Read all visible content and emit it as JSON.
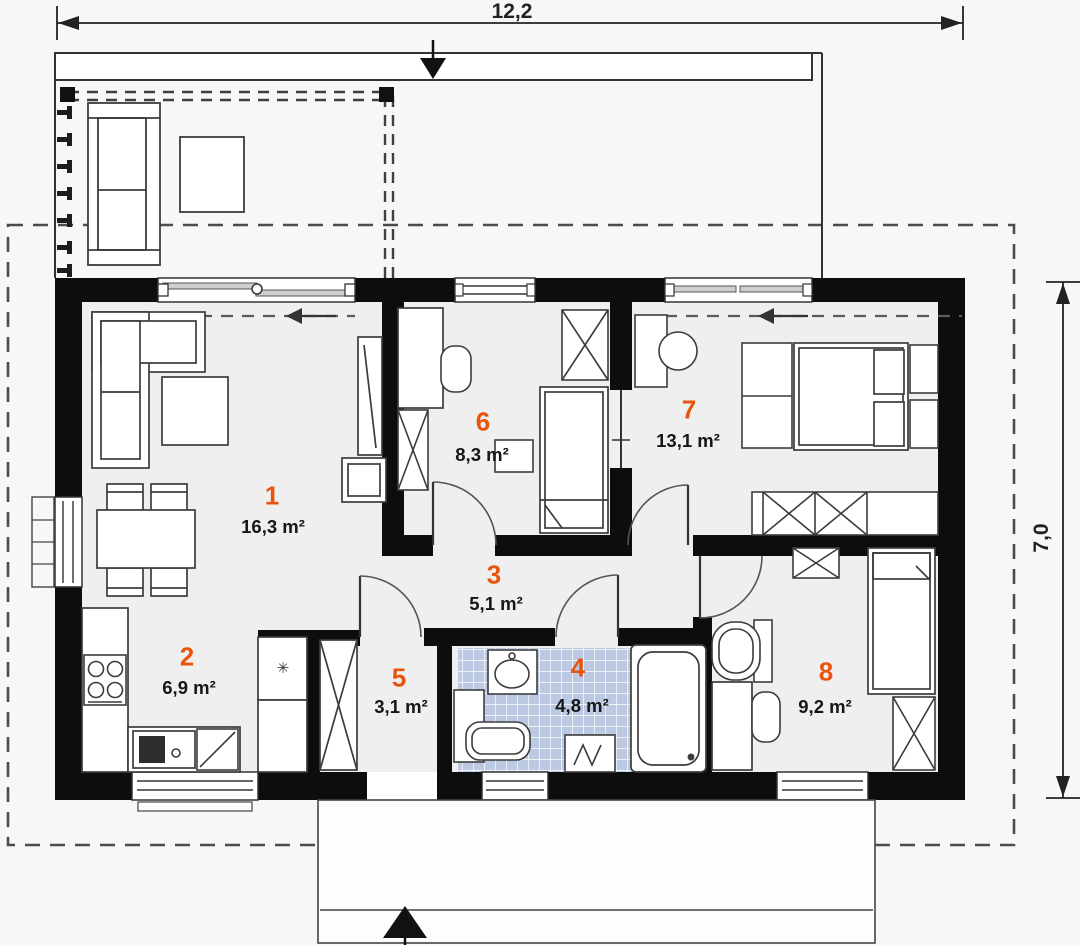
{
  "plan_title": "house-floor-plan",
  "dimensions": {
    "width_label": "12,2",
    "height_label": "7,0"
  },
  "rooms": [
    {
      "number": "1",
      "area": "16,3 m²",
      "name": "living-room"
    },
    {
      "number": "2",
      "area": "6,9 m²",
      "name": "kitchen"
    },
    {
      "number": "3",
      "area": "5,1 m²",
      "name": "hallway"
    },
    {
      "number": "4",
      "area": "4,8 m²",
      "name": "bathroom"
    },
    {
      "number": "5",
      "area": "3,1 m²",
      "name": "vestibule"
    },
    {
      "number": "6",
      "area": "8,3 m²",
      "name": "bedroom-small"
    },
    {
      "number": "7",
      "area": "13,1 m²",
      "name": "bedroom-main"
    },
    {
      "number": "8",
      "area": "9,2 m²",
      "name": "bedroom-rear"
    }
  ],
  "icons": {
    "fridge_snowflake": "✳"
  },
  "colors": {
    "wall": "#0d0d0d",
    "room_number": "#e8540c",
    "tile": "#bcc9e3",
    "floor": "#efefef"
  }
}
